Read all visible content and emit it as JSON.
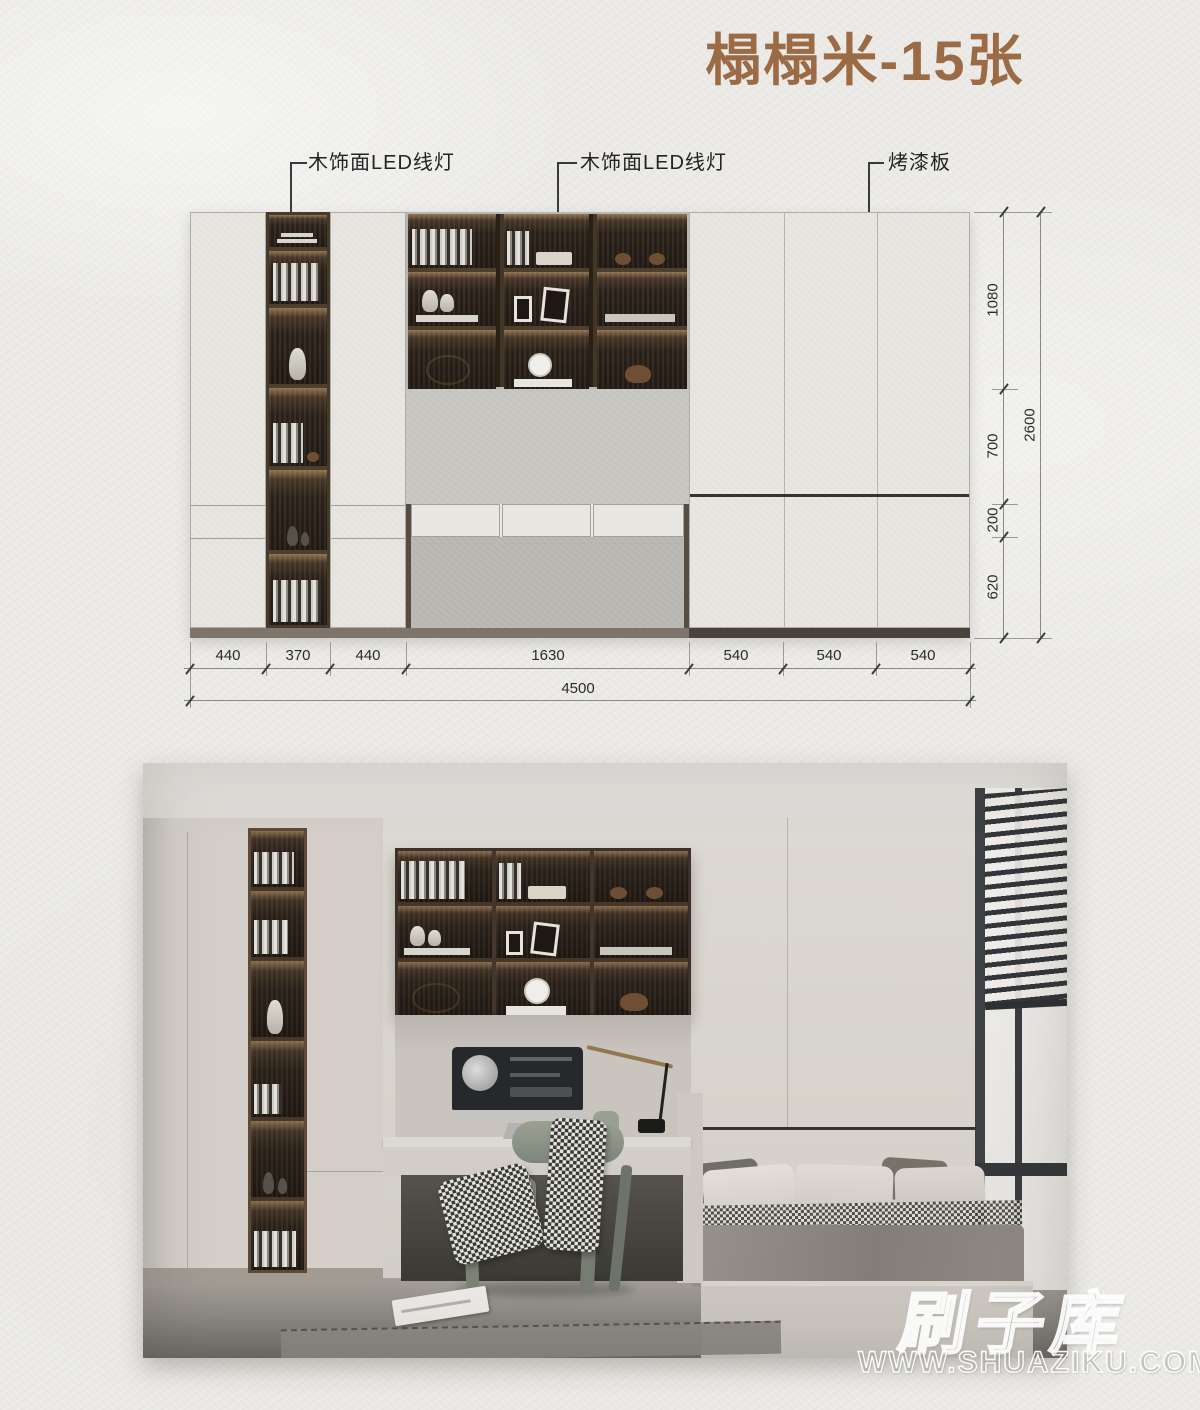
{
  "title": {
    "text": "榻榻米-15张",
    "color": "#9a6b44"
  },
  "annotations": {
    "led_label_1": "木饰面LED线灯",
    "led_label_2": "木饰面LED线灯",
    "paint_label": "烤漆板"
  },
  "dimensions": {
    "bottom_segments": [
      "440",
      "370",
      "440",
      "1630",
      "540",
      "540",
      "540"
    ],
    "bottom_total": "4500",
    "right_segments": [
      "1080",
      "700",
      "200",
      "620"
    ],
    "right_total": "2600"
  },
  "watermark": {
    "brand": "刷子库",
    "url": "WWW.SHUAZIKU.COM"
  },
  "colors": {
    "paper": "#edece9",
    "title_brown": "#9a6b44",
    "dim_text": "#2b2b2b",
    "dark_wood": "#2a211a"
  }
}
